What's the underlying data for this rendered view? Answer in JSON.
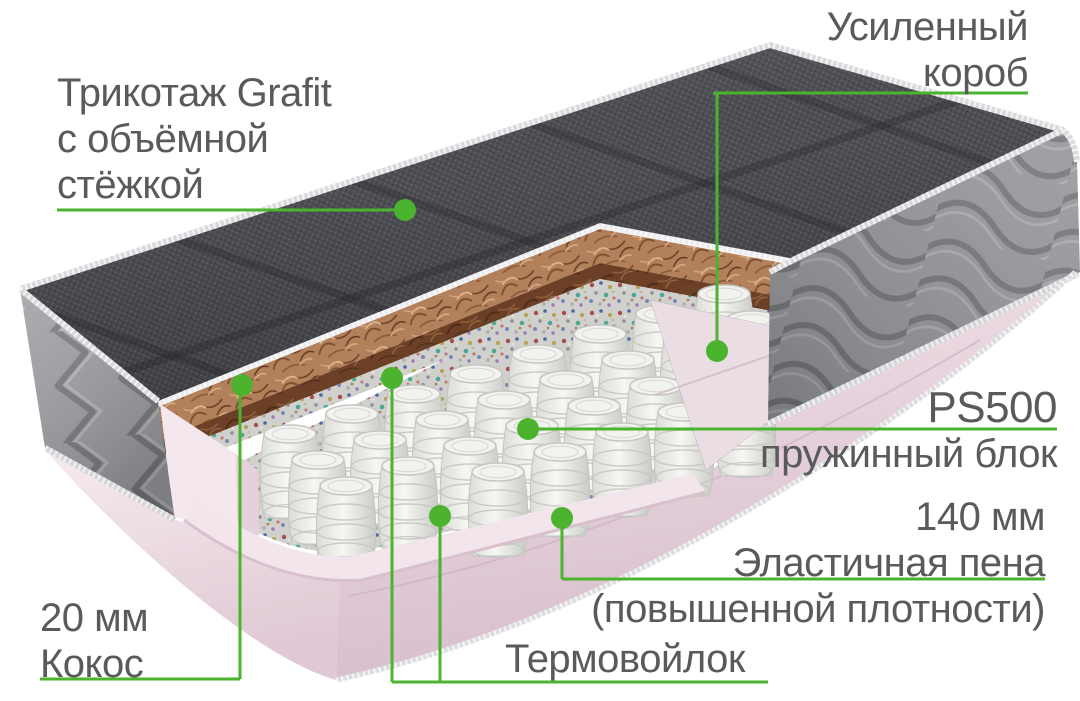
{
  "colors": {
    "accent": "#4bb32d",
    "text": "#595a5c",
    "background": "#ffffff"
  },
  "labels": {
    "fabric": {
      "lines": [
        "Трикотаж Grafit",
        "с объёмной",
        "стёжкой"
      ]
    },
    "box": {
      "lines": [
        "Усиленный",
        "короб"
      ]
    },
    "springs": {
      "model": "PS500",
      "name": "пружинный блок"
    },
    "foam": {
      "size": "140 мм",
      "name": "Эластичная пена",
      "note": "(повышенной плотности)"
    },
    "coconut": {
      "size": "20 мм",
      "name": "Кокос"
    },
    "felt": {
      "name": "Термовойлок"
    }
  }
}
